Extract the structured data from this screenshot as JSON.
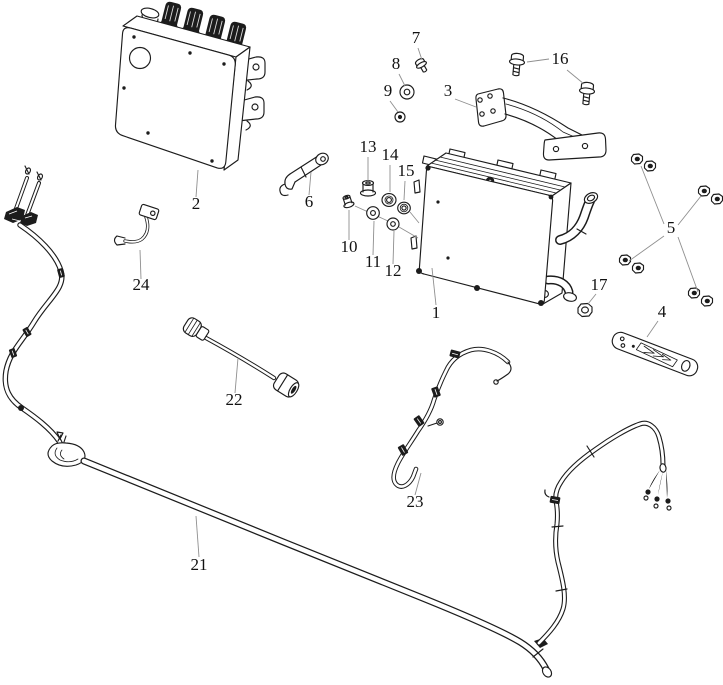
{
  "diagram": {
    "type": "exploded-parts-diagram",
    "figure": {
      "width": 723,
      "height": 685
    },
    "background_color": "#ffffff",
    "line_color": "#1c1c1c",
    "leader_color": "#8f8f8f",
    "label_color": "#111111",
    "label_font_size": 17,
    "part_numbers": [
      "1",
      "2",
      "3",
      "4",
      "5",
      "6",
      "7",
      "8",
      "9",
      "10",
      "11",
      "12",
      "13",
      "14",
      "15",
      "16",
      "17",
      "21",
      "22",
      "23",
      "24"
    ],
    "labels": [
      {
        "text": "1",
        "x": 436,
        "y": 318,
        "leaders": [
          [
            [
              436,
              305
            ],
            [
              432,
              268
            ]
          ]
        ]
      },
      {
        "text": "2",
        "x": 196,
        "y": 209,
        "leaders": [
          [
            [
              196,
              197
            ],
            [
              198,
              170
            ]
          ]
        ]
      },
      {
        "text": "3",
        "x": 448,
        "y": 96,
        "leaders": [
          [
            [
              455,
              99
            ],
            [
              476,
              107
            ]
          ]
        ]
      },
      {
        "text": "4",
        "x": 662,
        "y": 317,
        "leaders": [
          [
            [
              658,
              321
            ],
            [
              647,
              337
            ]
          ]
        ]
      },
      {
        "text": "5",
        "x": 671,
        "y": 233,
        "leaders": [
          [
            [
              664,
              224
            ],
            [
              641,
              166
            ]
          ],
          [
            [
              678,
              225
            ],
            [
              701,
              196
            ]
          ],
          [
            [
              664,
              236
            ],
            [
              629,
              261
            ]
          ],
          [
            [
              678,
              237
            ],
            [
              698,
              292
            ]
          ]
        ]
      },
      {
        "text": "6",
        "x": 309,
        "y": 207,
        "leaders": [
          [
            [
              309,
              195
            ],
            [
              311,
              172
            ]
          ]
        ]
      },
      {
        "text": "7",
        "x": 416,
        "y": 43,
        "leaders": [
          [
            [
              418,
              48
            ],
            [
              422,
              60
            ]
          ]
        ]
      },
      {
        "text": "8",
        "x": 396,
        "y": 69,
        "leaders": [
          [
            [
              399,
              74
            ],
            [
              405,
              86
            ]
          ]
        ]
      },
      {
        "text": "9",
        "x": 388,
        "y": 96,
        "leaders": [
          [
            [
              390,
              101
            ],
            [
              398,
              112
            ]
          ]
        ]
      },
      {
        "text": "10",
        "x": 349,
        "y": 252,
        "leaders": [
          [
            [
              349,
              240
            ],
            [
              349,
              210
            ]
          ]
        ]
      },
      {
        "text": "11",
        "x": 373,
        "y": 267,
        "leaders": [
          [
            [
              373,
              255
            ],
            [
              374,
              221
            ]
          ]
        ]
      },
      {
        "text": "12",
        "x": 393,
        "y": 276,
        "leaders": [
          [
            [
              393,
              264
            ],
            [
              394,
              231
            ]
          ]
        ]
      },
      {
        "text": "13",
        "x": 368,
        "y": 152,
        "leaders": [
          [
            [
              368,
              157
            ],
            [
              368,
              181
            ]
          ]
        ]
      },
      {
        "text": "14",
        "x": 390,
        "y": 160,
        "leaders": [
          [
            [
              390,
              165
            ],
            [
              390,
              192
            ]
          ]
        ]
      },
      {
        "text": "15",
        "x": 406,
        "y": 176,
        "leaders": [
          [
            [
              405,
              181
            ],
            [
              404,
              200
            ]
          ]
        ]
      },
      {
        "text": "16",
        "x": 560,
        "y": 64,
        "leaders": [
          [
            [
              549,
              59
            ],
            [
              527,
              62
            ]
          ],
          [
            [
              567,
              70
            ],
            [
              584,
              84
            ]
          ]
        ]
      },
      {
        "text": "17",
        "x": 599,
        "y": 290,
        "leaders": [
          [
            [
              596,
              294
            ],
            [
              588,
              304
            ]
          ]
        ]
      },
      {
        "text": "21",
        "x": 199,
        "y": 570,
        "leaders": [
          [
            [
              199,
              557
            ],
            [
              196,
              516
            ]
          ]
        ]
      },
      {
        "text": "22",
        "x": 234,
        "y": 405,
        "leaders": [
          [
            [
              235,
              393
            ],
            [
              238,
              358
            ]
          ]
        ]
      },
      {
        "text": "23",
        "x": 415,
        "y": 507,
        "leaders": [
          [
            [
              415,
              495
            ],
            [
              421,
              473
            ]
          ]
        ]
      },
      {
        "text": "24",
        "x": 141,
        "y": 290,
        "leaders": [
          [
            [
              141,
              279
            ],
            [
              140,
              250
            ]
          ]
        ]
      }
    ]
  }
}
